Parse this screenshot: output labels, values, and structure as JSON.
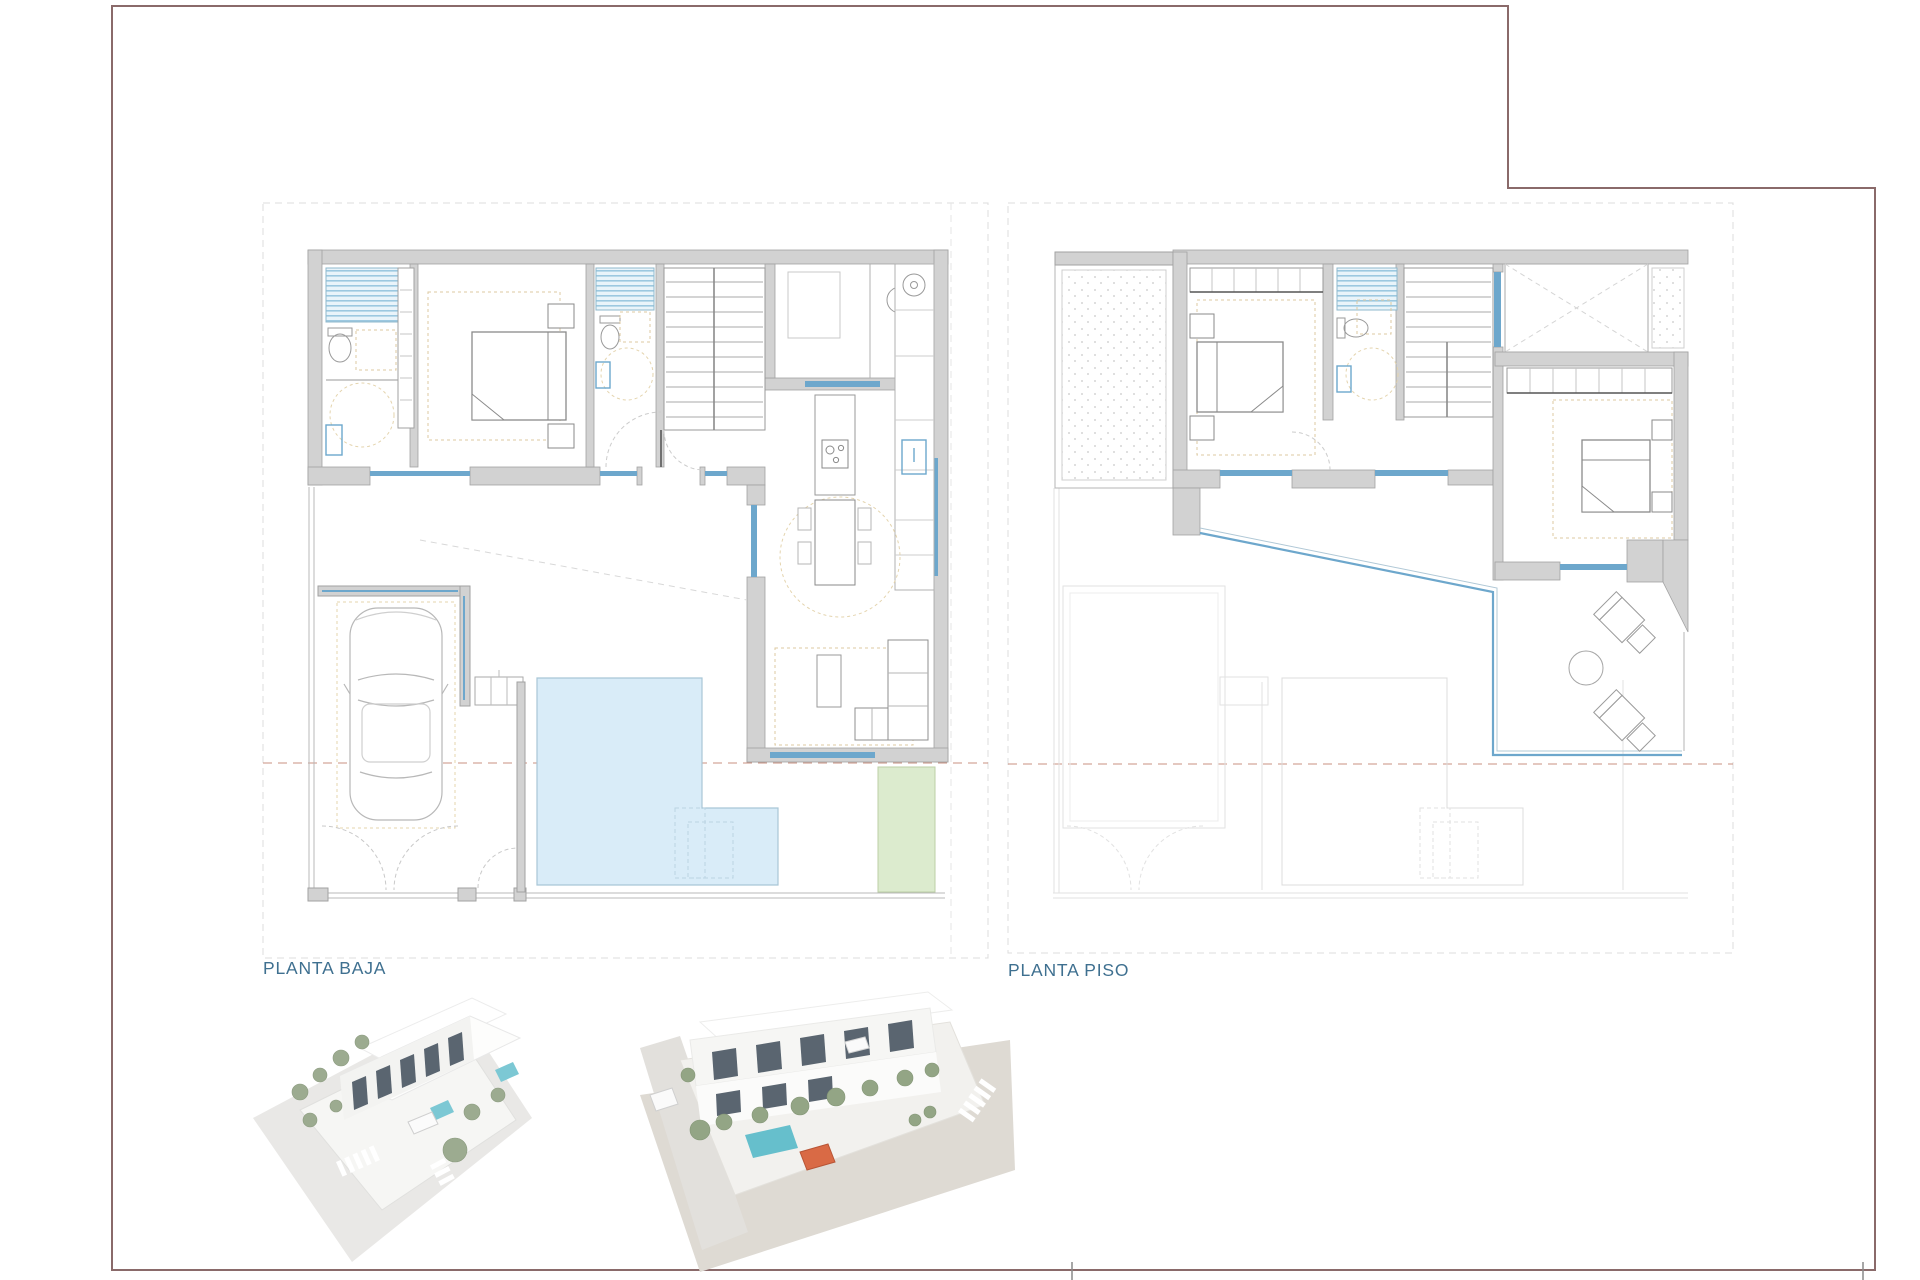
{
  "page": {
    "background": "#ffffff",
    "frame_color": "#8a6a6a",
    "description": "Architectural floor-plan sheet with two storey plans and two exterior 3D renders"
  },
  "plans": [
    {
      "id": "planta-baja",
      "label": "PLANTA BAJA"
    },
    {
      "id": "planta-piso",
      "label": "PLANTA PISO"
    }
  ],
  "colors": {
    "label_text": "#3f7090",
    "wall_fill": "#d2d2d2",
    "wall_stroke": "#a2a2a2",
    "window_blue": "#6da7cc",
    "shower_stripe": "#9cc8e0",
    "pool_fill": "#d9ecf8",
    "pool_stroke": "#a9c6d6",
    "garden_green": "#dcebce",
    "furniture_tan": "#dcc9a0",
    "plot_dash_gray": "#dcdcdc",
    "section_dash_red": "#c99080",
    "ghost_gray": "#e2e2e2",
    "render_street_gray": "#e9e8e6",
    "render_street_beige": "#dedad3",
    "render_building_white": "#fbfbfa",
    "render_window_dark": "#5a6570",
    "render_tree_green": "#9cab90",
    "render_pool_teal": "#6fc3cf",
    "render_car_orange": "#d96a45"
  },
  "renders": [
    {
      "name": "exterior-render-left"
    },
    {
      "name": "exterior-render-right"
    }
  ]
}
